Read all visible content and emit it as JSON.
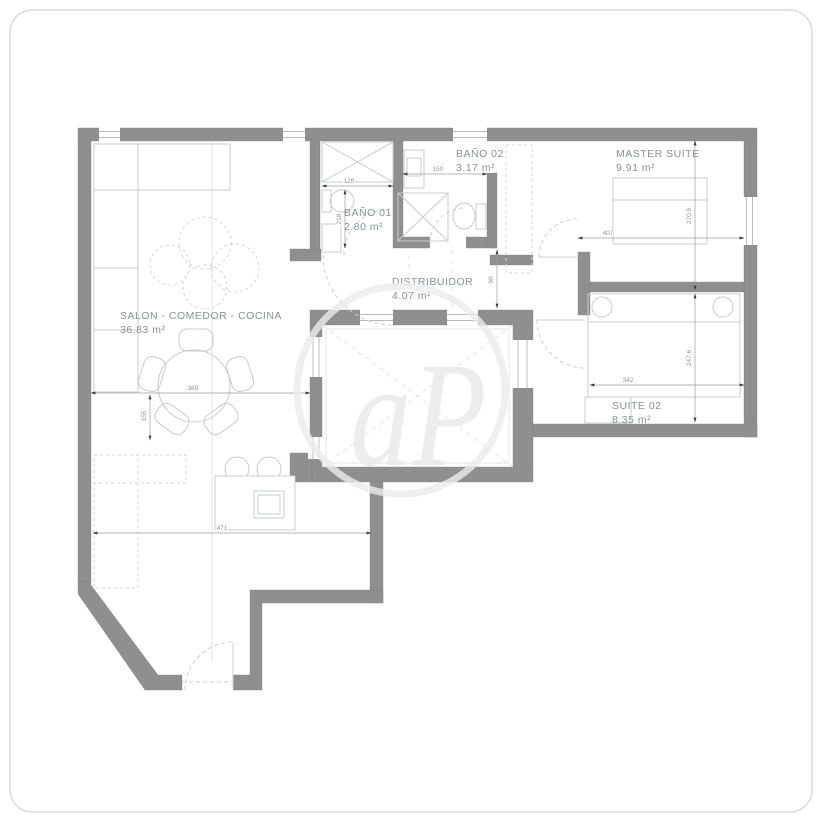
{
  "plan": {
    "watermark_text": "aP",
    "rooms": [
      {
        "id": "salon",
        "name": "SALON - COMEDOR - COCINA",
        "area": "36.83 m²"
      },
      {
        "id": "bano01",
        "name": "BAÑO 01",
        "area": "2.80 m²"
      },
      {
        "id": "bano02",
        "name": "BAÑO 02",
        "area": "3.17 m²"
      },
      {
        "id": "distribuidor",
        "name": "DISTRIBUIDOR",
        "area": "4.07 m²"
      },
      {
        "id": "master",
        "name": "MASTER SUITE",
        "area": "9.91 m²"
      },
      {
        "id": "suite02",
        "name": "SUITE 02",
        "area": "8.35 m²"
      }
    ],
    "dimensions": {
      "bano01_width": "120",
      "bano01_depth": "218",
      "bano02_width": "150",
      "distribuidor_depth": "90",
      "master_width": "407",
      "master_depth": "270.5",
      "suite02_width": "342",
      "suite02_depth": "247.6",
      "salon_width": "389",
      "salon_depth": "155",
      "kitchen_width": "471"
    },
    "colors": {
      "wall": "#8f8f8f",
      "furniture": "#c7cbce",
      "label": "#8a8f93",
      "dimension": "#8f9497",
      "watermark": "#ebebeb"
    }
  }
}
